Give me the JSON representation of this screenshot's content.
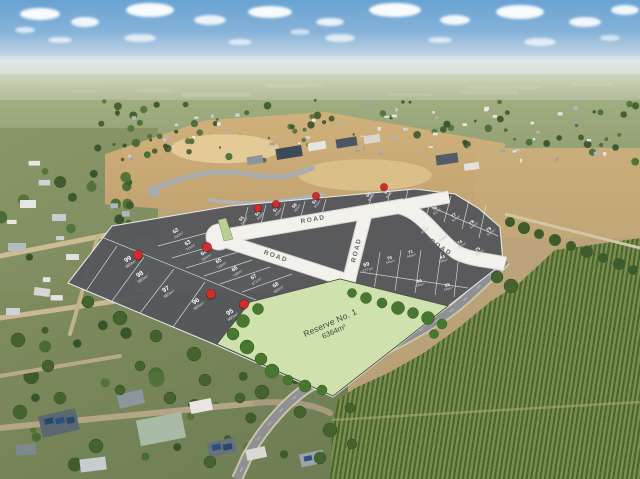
{
  "map": {
    "type": "land-subdivision-aerial-site-plan",
    "reserve": {
      "name": "Reserve No. 1",
      "area": "6364m²"
    },
    "road_label_text": "ROAD",
    "sold_marker_color": "#d22c2a",
    "colors": {
      "lot_fill": "#56585c",
      "lot_line": "#e3e5e8",
      "road_fill": "#f3f1ec",
      "reserve_fill": "#cfe2ae",
      "tree": "#487830",
      "sold_dot": "#d22c2a"
    },
    "road_labels": [
      {
        "x": 313,
        "y": 219,
        "rot": -10
      },
      {
        "x": 276,
        "y": 256,
        "rot": 20
      },
      {
        "x": 356,
        "y": 250,
        "rot": -76
      },
      {
        "x": 441,
        "y": 247,
        "rot": 33
      }
    ],
    "lots": [
      {
        "num": "99",
        "area": "989m²",
        "x": 129,
        "y": 261,
        "rot": -33,
        "size": "lg",
        "sold": true,
        "dx": 9,
        "dy": -6
      },
      {
        "num": "98",
        "area": "985m²",
        "x": 141,
        "y": 276,
        "rot": -33,
        "size": "lg",
        "sold": false
      },
      {
        "num": "97",
        "area": "985m²",
        "x": 167,
        "y": 291,
        "rot": -33,
        "size": "lg",
        "sold": false
      },
      {
        "num": "96",
        "area": "985m²",
        "x": 197,
        "y": 303,
        "rot": -33,
        "size": "lg",
        "sold": true,
        "dx": 14,
        "dy": -9
      },
      {
        "num": "95",
        "area": "985m²",
        "x": 231,
        "y": 314,
        "rot": -33,
        "size": "lg",
        "sold": true,
        "dx": 13,
        "dy": -10
      },
      {
        "num": "62",
        "area": "750m²",
        "x": 177,
        "y": 233,
        "rot": -33,
        "size": "md",
        "sold": false
      },
      {
        "num": "63",
        "area": "715m²",
        "x": 189,
        "y": 245,
        "rot": -33,
        "size": "md",
        "sold": false
      },
      {
        "num": "64",
        "area": "585m²",
        "x": 205,
        "y": 255,
        "rot": -33,
        "size": "md",
        "sold": true,
        "dx": 2,
        "dy": -8
      },
      {
        "num": "65",
        "area": "748m²",
        "x": 220,
        "y": 263,
        "rot": -33,
        "size": "md",
        "sold": false
      },
      {
        "num": "66",
        "area": "748m²",
        "x": 236,
        "y": 271,
        "rot": -33,
        "size": "md",
        "sold": false
      },
      {
        "num": "67",
        "area": "671m²",
        "x": 255,
        "y": 279,
        "rot": -33,
        "size": "md",
        "sold": false
      },
      {
        "num": "68",
        "area": "689m²",
        "x": 277,
        "y": 287,
        "rot": -33,
        "size": "md",
        "sold": false
      },
      {
        "num": "55",
        "area": "750m²",
        "x": 243,
        "y": 220,
        "rot": -50,
        "size": "sm",
        "sold": false
      },
      {
        "num": "56",
        "area": "588m²",
        "x": 259,
        "y": 215,
        "rot": -50,
        "size": "sm",
        "sold": true,
        "dx": -1,
        "dy": -7
      },
      {
        "num": "57",
        "area": "588m²",
        "x": 277,
        "y": 211,
        "rot": -50,
        "size": "sm",
        "sold": true,
        "dx": -1,
        "dy": -7
      },
      {
        "num": "58",
        "area": "588m²",
        "x": 296,
        "y": 207,
        "rot": -50,
        "size": "sm",
        "sold": false
      },
      {
        "num": "59",
        "area": "588m²",
        "x": 316,
        "y": 203,
        "rot": -50,
        "size": "sm",
        "sold": true,
        "dx": 0,
        "dy": -7
      },
      {
        "num": "60",
        "area": "606m²",
        "x": 370,
        "y": 196,
        "rot": -50,
        "size": "sm",
        "sold": false
      },
      {
        "num": "61",
        "area": "606m²",
        "x": 388,
        "y": 193,
        "rot": -50,
        "size": "sm",
        "sold": true,
        "dx": -4,
        "dy": -6
      },
      {
        "num": "76",
        "area": "602m²",
        "x": 436,
        "y": 210,
        "rot": -36,
        "size": "sm",
        "sold": false
      },
      {
        "num": "77",
        "area": "540m²",
        "x": 455,
        "y": 217,
        "rot": -36,
        "size": "sm",
        "sold": false
      },
      {
        "num": "78",
        "area": "540m²",
        "x": 473,
        "y": 224,
        "rot": -36,
        "size": "sm",
        "sold": false
      },
      {
        "num": "79",
        "area": "540m²",
        "x": 490,
        "y": 231,
        "rot": -36,
        "size": "sm",
        "sold": false
      },
      {
        "num": "72",
        "area": "546m²",
        "x": 424,
        "y": 229,
        "rot": -36,
        "size": "sm",
        "sold": false
      },
      {
        "num": "73",
        "area": "540m²",
        "x": 442,
        "y": 237,
        "rot": -36,
        "size": "sm",
        "sold": false
      },
      {
        "num": "74",
        "area": "540m²",
        "x": 461,
        "y": 244,
        "rot": -36,
        "size": "sm",
        "sold": false
      },
      {
        "num": "75",
        "area": "540m²",
        "x": 479,
        "y": 251,
        "rot": -36,
        "size": "sm",
        "sold": false
      },
      {
        "num": "69",
        "area": "677m²",
        "x": 367,
        "y": 267,
        "rot": -15,
        "size": "md",
        "sold": false
      },
      {
        "num": "70",
        "area": "545m²",
        "x": 390,
        "y": 260,
        "rot": -15,
        "size": "sm",
        "sold": false
      },
      {
        "num": "71",
        "area": "545m²",
        "x": 411,
        "y": 254,
        "rot": -15,
        "size": "sm",
        "sold": false
      },
      {
        "num": "84",
        "area": "636m²",
        "x": 443,
        "y": 259,
        "rot": -15,
        "size": "sm",
        "sold": false
      },
      {
        "num": "86",
        "area": "545m²",
        "x": 420,
        "y": 283,
        "rot": -15,
        "size": "sm",
        "sold": false
      },
      {
        "num": "85",
        "area": "545m²",
        "x": 448,
        "y": 287,
        "rot": -15,
        "size": "sm",
        "sold": false
      }
    ]
  }
}
